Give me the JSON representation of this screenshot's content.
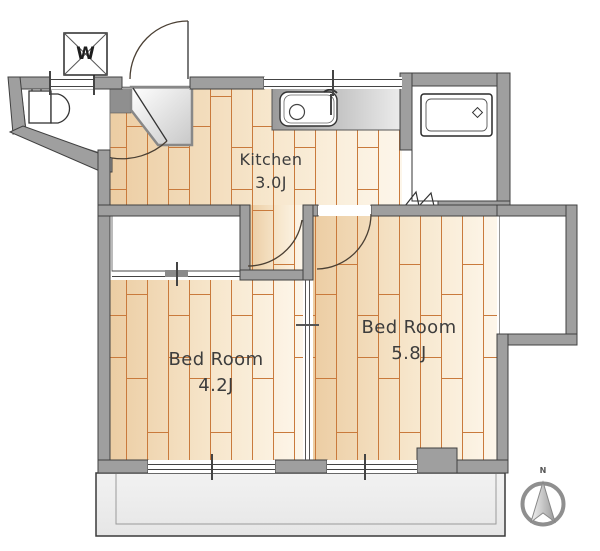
{
  "plan": {
    "rooms": [
      {
        "id": "kitchen",
        "name": "Kitchen",
        "size": "3.0J"
      },
      {
        "id": "bedroom-4-2",
        "name": "Bed Room",
        "size": "4.2J"
      },
      {
        "id": "bedroom-5-8",
        "name": "Bed Room",
        "size": "5.8J"
      }
    ],
    "washer_label": "W",
    "compass": {
      "north_label": "N"
    },
    "colors": {
      "wall_fill": "#9f9f9f",
      "wall_outline": "#404040",
      "wood_dark": "#eccda3",
      "wood_light": "#fdf6ea",
      "plank_line": "#c97a3c",
      "balcony_fill": "#ededed",
      "door_arc": "#4a3f33",
      "label_text": "#3d3d3d"
    }
  }
}
